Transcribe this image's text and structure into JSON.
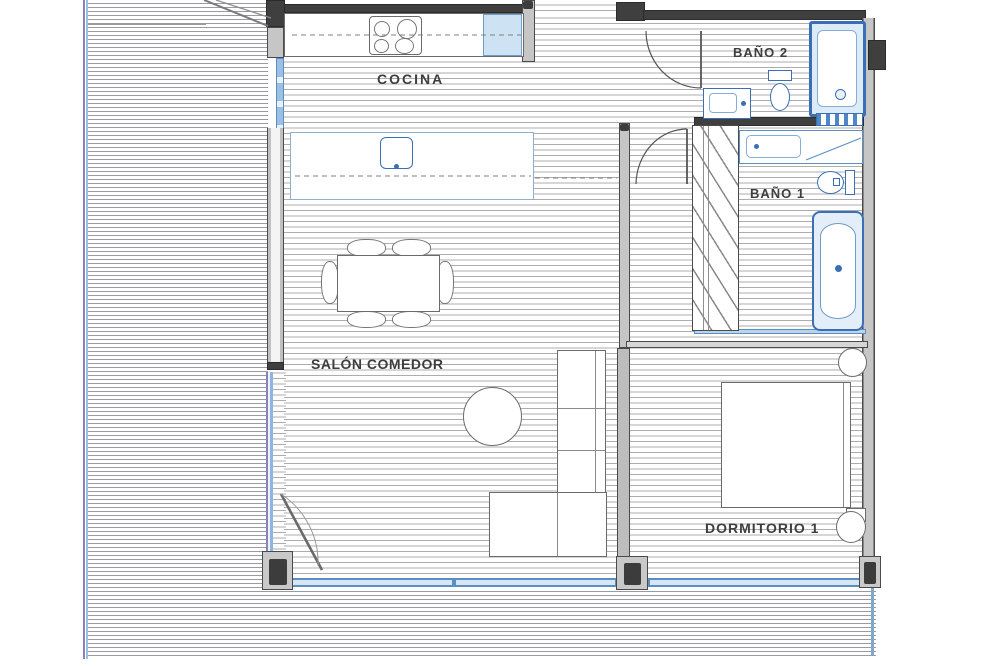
{
  "rooms": {
    "cocina": "COCINA",
    "salon_comedor": "SALÓN COMEDOR",
    "bano2": "BAÑO 2",
    "bano1": "BAÑO 1",
    "dormitorio1": "DORMITORIO 1"
  },
  "colors": {
    "wall_dark": "#3f3f3f",
    "wall_gray": "#c6c6c6",
    "fixture_blue": "#3a6fb5",
    "fixture_blue_light": "#d7e6f4",
    "glass_purple": "#8d82b8",
    "hatch_line_terrace": "#9a9aa2",
    "hatch_line_floor": "#adadad",
    "label_text": "#3e3e3e"
  }
}
